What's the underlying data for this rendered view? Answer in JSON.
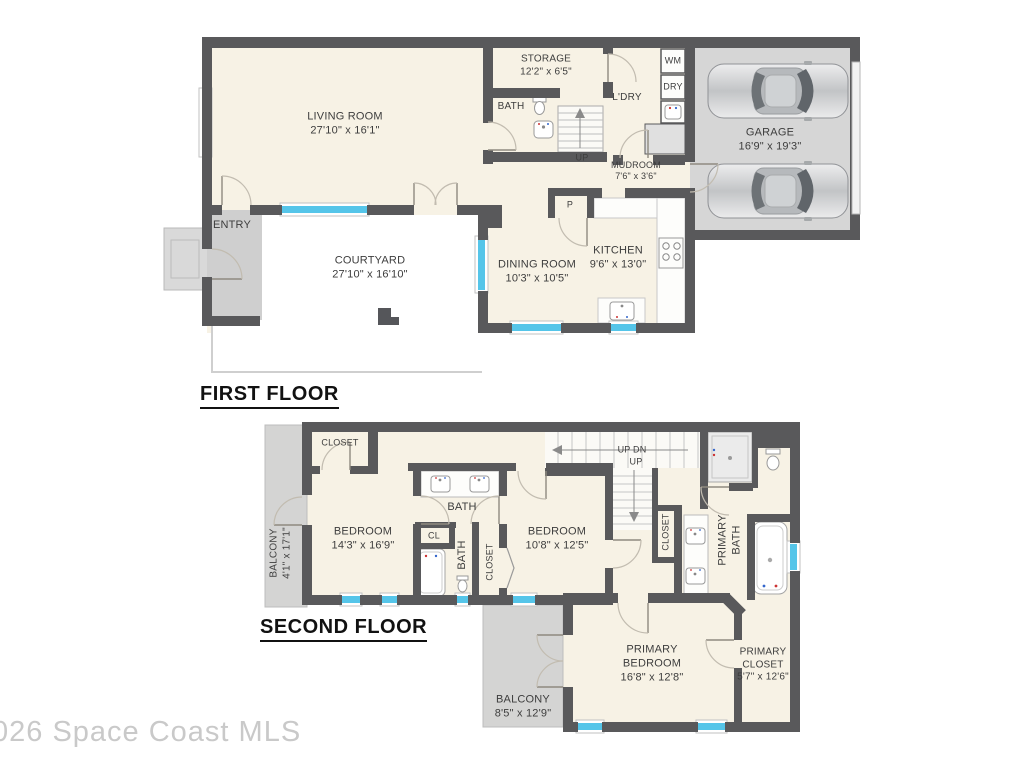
{
  "watermark": "026 Space Coast MLS",
  "first_floor": {
    "title": "FIRST FLOOR",
    "rooms": {
      "living_room": {
        "name": "LIVING ROOM",
        "dims": "27'10\" x 16'1\""
      },
      "storage": {
        "name": "STORAGE",
        "dims": "12'2\" x 6'5\""
      },
      "bath": {
        "name": "BATH"
      },
      "laundry": {
        "name": "L'DRY"
      },
      "washer": {
        "name": "WM"
      },
      "dryer": {
        "name": "DRY"
      },
      "stairs_up": {
        "name": "UP"
      },
      "mudroom": {
        "name": "MUDROOM",
        "dims": "7'6\" x 3'6\""
      },
      "garage": {
        "name": "GARAGE",
        "dims": "16'9\" x 19'3\""
      },
      "entry": {
        "name": "ENTRY"
      },
      "courtyard": {
        "name": "COURTYARD",
        "dims": "27'10\" x 16'10\""
      },
      "dining_room": {
        "name": "DINING ROOM",
        "dims": "10'3\" x 10'5\""
      },
      "kitchen": {
        "name": "KITCHEN",
        "dims": "9'6\" x 13'0\""
      },
      "pantry": {
        "name": "P"
      }
    }
  },
  "second_floor": {
    "title": "SECOND FLOOR",
    "rooms": {
      "balcony_left": {
        "name": "BALCONY",
        "dims": "4'1\" x 17'1\""
      },
      "closet_top": {
        "name": "CLOSET"
      },
      "bedroom_left": {
        "name": "BEDROOM",
        "dims": "14'3\" x 16'9\""
      },
      "bath_top": {
        "name": "BATH"
      },
      "closet_cl": {
        "name": "CL"
      },
      "bath_mid": {
        "name": "BATH"
      },
      "closet_mid": {
        "name": "CLOSET"
      },
      "bedroom_right": {
        "name": "BEDROOM",
        "dims": "10'8\" x 12'5\""
      },
      "stairs_top": {
        "name": "UP  DN"
      },
      "stairs_up": {
        "name": "UP"
      },
      "closet_right": {
        "name": "CLOSET"
      },
      "primary_bath": {
        "name": "PRIMARY\nBATH"
      },
      "primary_bedroom": {
        "name": "PRIMARY\nBEDROOM",
        "dims": "16'8\" x 12'8\""
      },
      "primary_closet": {
        "name": "PRIMARY\nCLOSET",
        "dims": "5'7\" x 12'6\""
      },
      "balcony_bottom": {
        "name": "BALCONY",
        "dims": "8'5\" x 12'9\""
      }
    }
  },
  "colors": {
    "wall": "#59595b",
    "floor": "#f7f2e5",
    "outdoor": "#d4d4d3",
    "window": "#55c5e9",
    "courtyard": "#ffffff"
  }
}
